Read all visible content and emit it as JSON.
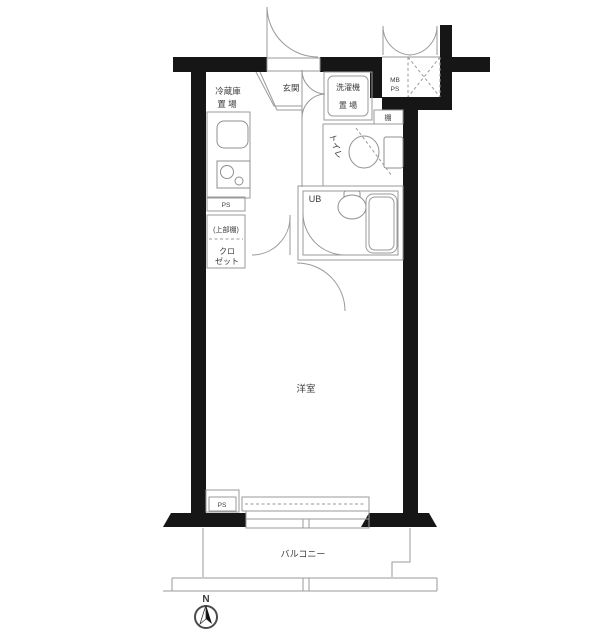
{
  "floorplan": {
    "colors": {
      "wall": "#161616",
      "thin_line": "#9a9a9a",
      "text": "#3c3c3c",
      "background": "#ffffff"
    },
    "labels": {
      "refrigerator_line1": "冷蔵庫",
      "refrigerator_line2": "置 場",
      "entrance": "玄関",
      "washer_line1": "洗濯機",
      "washer_line2": "置 場",
      "meter_box_line1": "MB",
      "meter_box_line2": "PS",
      "shelf": "棚",
      "toilet": "トイレ",
      "unit_bath": "UB",
      "kitchen_pipe_space": "PS",
      "upper_shelf": "(上部棚)",
      "closet_line1": "クロ",
      "closet_line2": "ゼット",
      "western_room": "洋室",
      "bottom_pipe_space": "PS",
      "balcony": "バルコニー",
      "compass_north": "N"
    }
  }
}
